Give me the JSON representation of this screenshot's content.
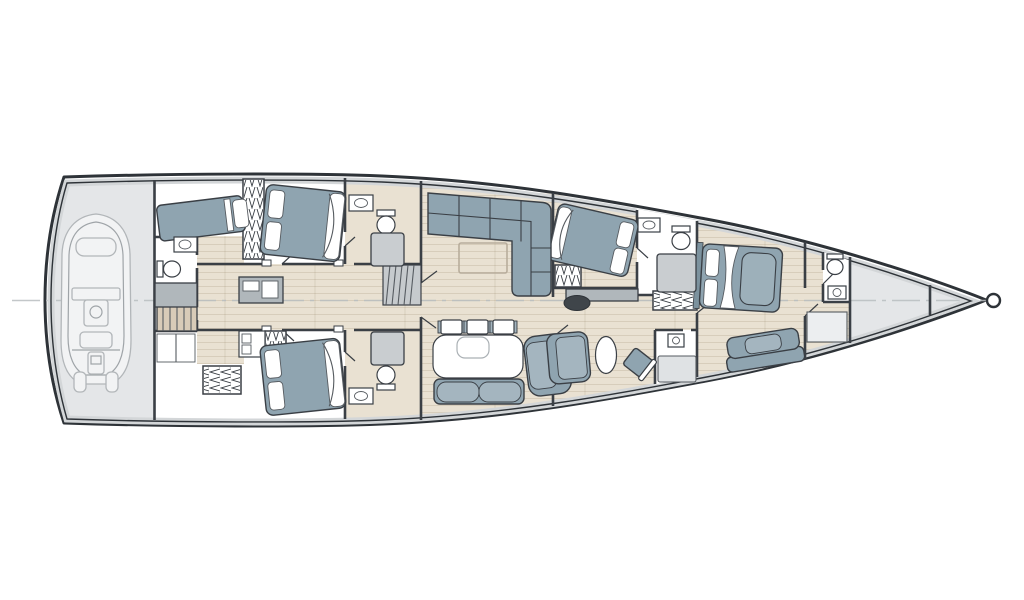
{
  "page": {
    "description": "Sailing yacht lower-deck interior floor plan, stern at left, bow pointing right",
    "diagram_type": "yacht-deck-plan",
    "orientation": "bow-right",
    "has_centerline": true
  },
  "palette": {
    "background": "#ffffff",
    "hull_line": "#2e3338",
    "wall_line": "#3a3f45",
    "detail_line": "#565b60",
    "deck_gray": "#e4e6e8",
    "side_deck_band": "#d3d6d8",
    "wood_floor": "#e9e1d2",
    "stair_wood": "#d8cbb8",
    "stair_gray": "#c6cacd",
    "upholstery": "#8fa4b0",
    "upholstery_light": "#a4b5bf",
    "blanket": "#9db0ba",
    "headboard": "#7c929e",
    "fixture_white": "#ffffff",
    "shower_gray": "#c9cdd0",
    "shower_tray": "#dfe2e4",
    "cabinet_gray": "#b0b7bb",
    "panel_gray": "#eceef0",
    "tender_line": "#b2b6b9",
    "tender_fill": "#f2f3f4",
    "centerline": "#b9bdc0",
    "mast": "#3f454a",
    "plank_line": "rgba(120,100,70,0.22)"
  },
  "plan": {
    "rooms": [
      {
        "id": "tender-garage",
        "name": "Stern tender garage with dinghy"
      },
      {
        "id": "aft-crew-cabin",
        "name": "Aft cabin with single berth, WC and stairs"
      },
      {
        "id": "guest-cabin-port",
        "name": "Port guest cabin with double bed and ensuite"
      },
      {
        "id": "guest-cabin-starboard",
        "name": "Starboard guest cabin with double bed and ensuite"
      },
      {
        "id": "corridor",
        "name": "Central corridor with amidships stairs"
      },
      {
        "id": "salon",
        "name": "Salon with L-shaped sofa and coffee table"
      },
      {
        "id": "dining",
        "name": "Dining area with table, chairs, bench and armchair"
      },
      {
        "id": "vip-cabin",
        "name": "VIP cabin with double bed and ensuite"
      },
      {
        "id": "owner-study",
        "name": "Owner's study with oval table, seat and desk chair"
      },
      {
        "id": "owner-cabin",
        "name": "Owner's cabin with double bed and sofa"
      },
      {
        "id": "fwd-crew",
        "name": "Forward crew compartment with WC and berth"
      },
      {
        "id": "sail-locker",
        "name": "Forepeak sail locker"
      }
    ],
    "inventory": {
      "beds": 5,
      "toilets": 5,
      "sinks": 6,
      "showers": 4,
      "wardrobes": 5,
      "staircases": 2,
      "sofas_and_seats": 5,
      "tables": 3,
      "dining_chairs": 3,
      "desk_chairs": 1,
      "tenders": 1,
      "masts": 1
    }
  }
}
